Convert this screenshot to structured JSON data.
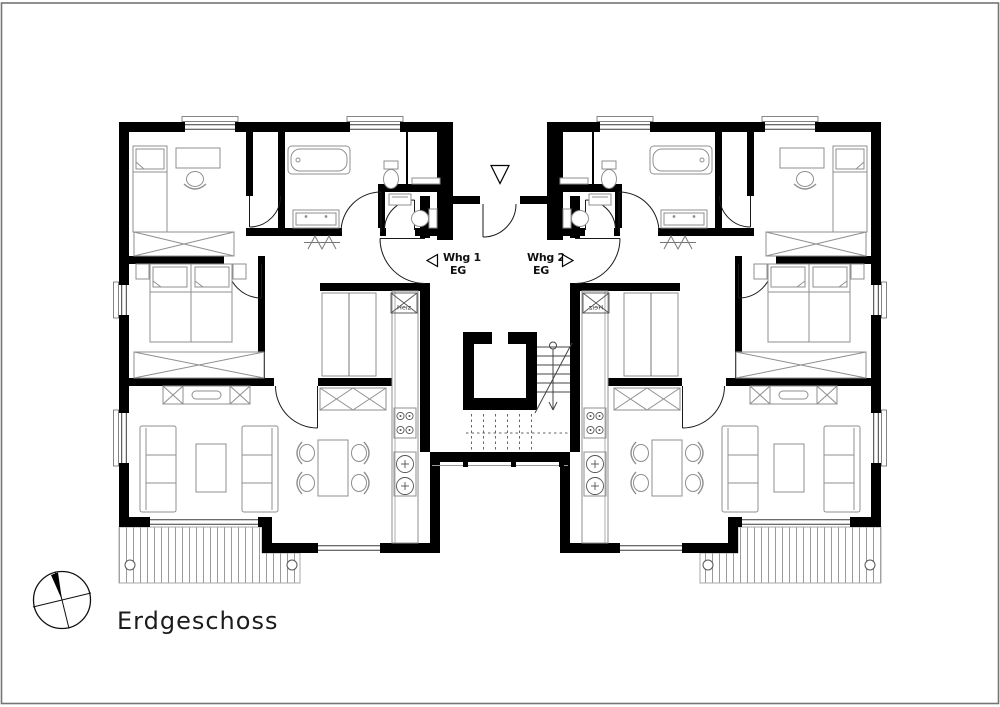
{
  "title": {
    "text": "Erdgeschoss"
  },
  "labels": {
    "apartment1": {
      "name": "Whg 1",
      "floor": "EG"
    },
    "apartment2": {
      "name": "Whg 2",
      "floor": "EG"
    },
    "heating": "Heiz"
  },
  "symbols": {
    "north_indicator": "north-arrow-compass-circle",
    "entrance_marker": "downward-triangle",
    "apartment1_marker": "left-triangle",
    "apartment2_marker": "right-triangle",
    "heating_unit": "crossed-box",
    "wardrobes": "crossed-rectangle",
    "stair_direction": "circle-line-arrow",
    "terrace": "vertical-hatch"
  },
  "colors": {
    "background": "#ffffff",
    "walls": "#000000",
    "furniture_stroke": "#8f8f8f",
    "thin_lines": "#3a3a3a",
    "hatch": "#9a9a9a",
    "page_border": "#757575",
    "text": "#1c1c1c"
  }
}
